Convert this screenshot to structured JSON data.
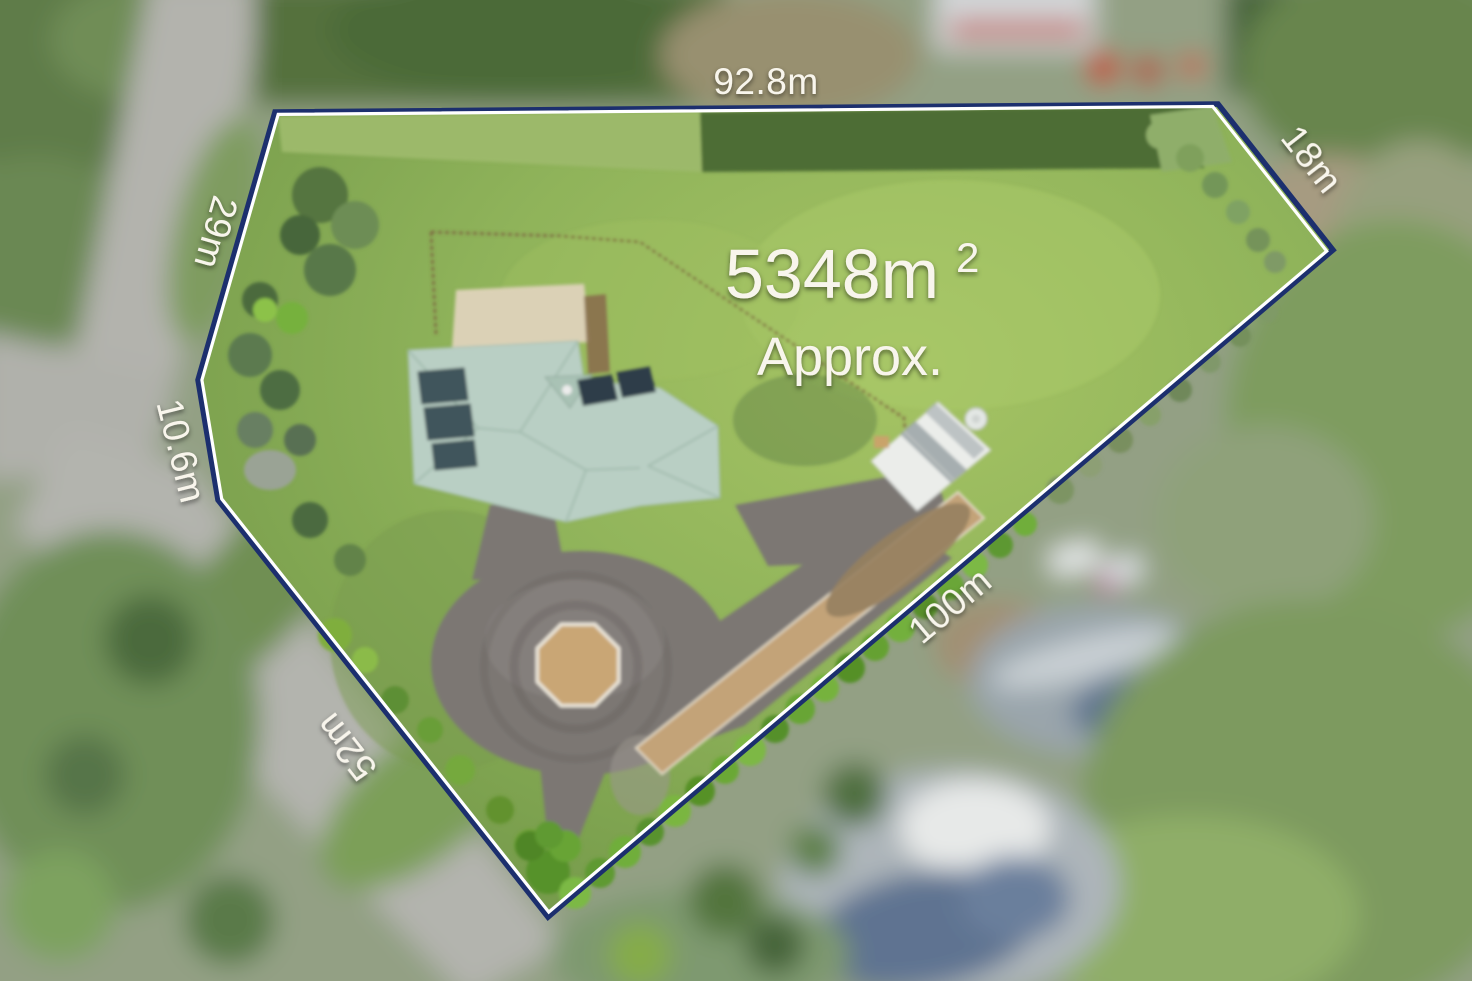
{
  "overlay": {
    "area": {
      "value": "5348m",
      "superscript": "2",
      "qualifier": "Approx."
    },
    "dimensions": [
      {
        "side": "top",
        "label": "92.8m"
      },
      {
        "side": "upper-right",
        "label": "18m"
      },
      {
        "side": "lower-right",
        "label": "100m"
      },
      {
        "side": "lower-left",
        "label": "52m"
      },
      {
        "side": "left-lower",
        "label": "10.6m"
      },
      {
        "side": "left-upper",
        "label": "29m"
      }
    ],
    "colors": {
      "boundary_line": "#1c2f6e",
      "boundary_inner_highlight": "#ffffff",
      "label_text": "#f8f5ec"
    }
  }
}
